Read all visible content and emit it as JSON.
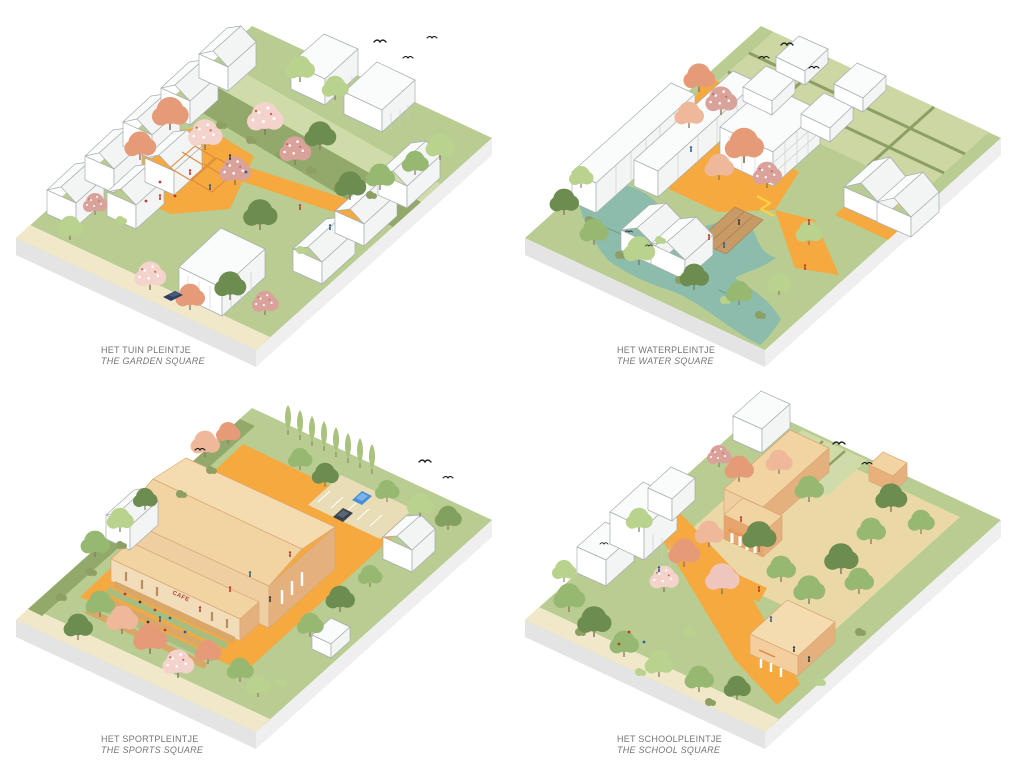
{
  "page": {
    "background": "#ffffff"
  },
  "palette": {
    "grass": "#b9cc92",
    "road": "#f0e8c8",
    "orange": "#f6a93f",
    "orangeLight": "#f6c66a",
    "water": "#8cbcab",
    "plotGreen": "#ccd7a4",
    "yard": "#ead9a6",
    "corridor": "#93a96c",
    "corridorLight": "#cfdba9",
    "parking": "#e8ddb6",
    "plinthL": "#e4e4e4",
    "plinthR": "#efefef",
    "line": "#a7adb0",
    "hedge": "#8d9f63",
    "wood": "#c79a66",
    "roofTan": "#f2d3a2",
    "roofTanL": "#f5dcb0",
    "roofEdge": "#d9a873",
    "wallTan": "#efcfa2",
    "wallTanD": "#e4b07e",
    "cream": "#f2ddbb",
    "ghOrange": "#e08a3c",
    "treeGreen": "#97b871",
    "treeGreenLight": "#b9d38f",
    "treeGreenDark": "#6d8c4f",
    "treeOlive": "#82a05f",
    "salmon": "#e69b78",
    "salmonLight": "#f0b89a",
    "pink": "#d9a29a",
    "pinkLight": "#eec6bd",
    "blossom": "#f3d3cb",
    "cypress": "#a9c27d",
    "accentRed": "#c0392b",
    "accentBlue": "#2c5f8a",
    "carBlue": "#4a90d9",
    "carDark": "#39424e",
    "carNavy": "#2e4163",
    "textRed": "#b5433a",
    "textOrange": "#e2853f",
    "caption": "#757575"
  },
  "panels": [
    {
      "id": "garden-square",
      "caption_nl": "HET TUIN PLEINTJE",
      "caption_en": "THE GARDEN SQUARE"
    },
    {
      "id": "water-square",
      "caption_nl": "HET WATERPLEINTJE",
      "caption_en": "THE WATER SQUARE"
    },
    {
      "id": "sports-square",
      "caption_nl": "HET SPORTPLEINTJE",
      "caption_en": "THE SPORTS SQUARE",
      "facade_label": "CAFE"
    },
    {
      "id": "school-square",
      "caption_nl": "HET SCHOOLPLEINTJE",
      "caption_en": "THE SCHOOL SQUARE",
      "facade_label": "SCHOOL"
    }
  ]
}
